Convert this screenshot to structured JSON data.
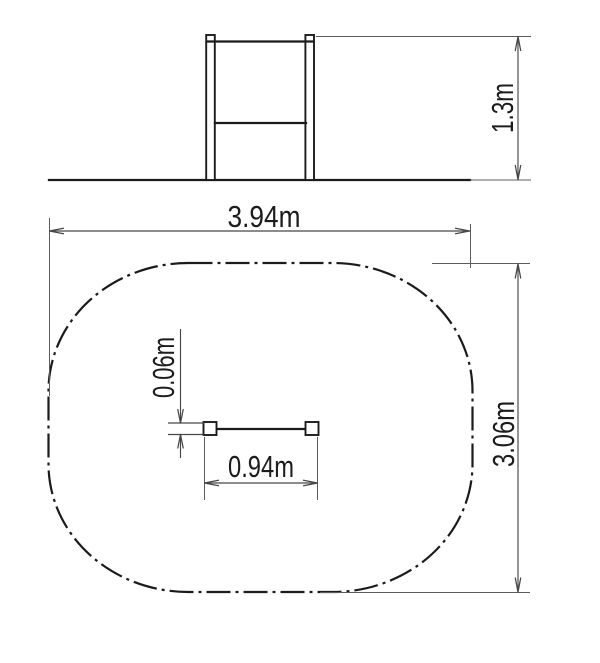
{
  "labels": {
    "front_height": "1.3m",
    "zone_width": "3.94m",
    "zone_depth": "3.06m",
    "bar_length": "0.94m",
    "bar_thickness": "0.06m"
  },
  "colors": {
    "background": "#ffffff",
    "object_line": "#1b1b1b",
    "dimension_line": "#474747",
    "extension_line": "#5c5c5c",
    "label_text": "#1c1c1c"
  }
}
